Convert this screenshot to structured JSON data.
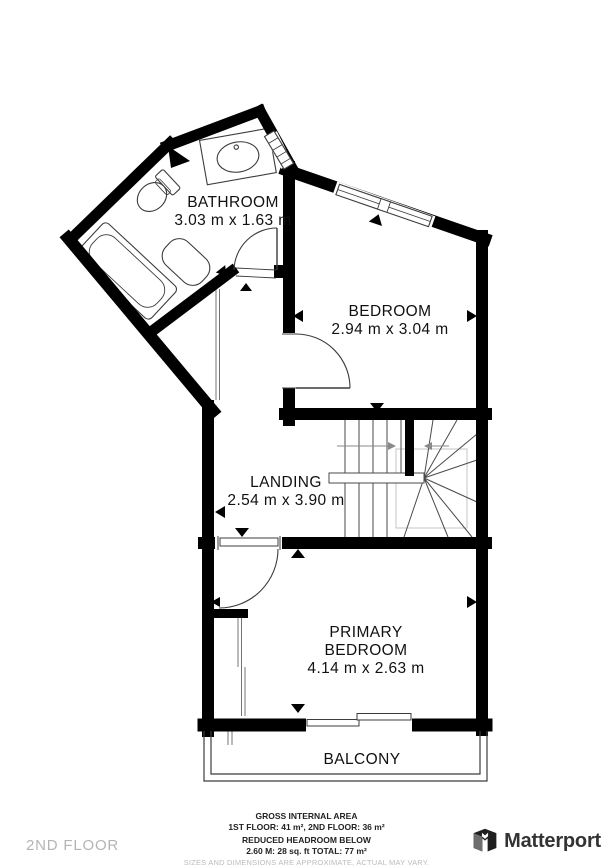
{
  "floor_plan": {
    "rooms": {
      "bathroom": {
        "name": "BATHROOM",
        "dims": "3.03 m x 1.63 m"
      },
      "bedroom": {
        "name": "BEDROOM",
        "dims": "2.94 m x 3.04 m"
      },
      "landing": {
        "name": "LANDING",
        "dims": "2.54 m x 3.90 m"
      },
      "primary_bedroom": {
        "name_line1": "PRIMARY",
        "name_line2": "BEDROOM",
        "dims": "4.14 m x 2.63 m"
      },
      "balcony": {
        "name": "BALCONY"
      }
    }
  },
  "footer": {
    "gross_area_title": "GROSS INTERNAL AREA",
    "gross_area_values": "1ST FLOOR: 41 m², 2ND FLOOR: 36 m²",
    "reduced_headroom_title": "REDUCED HEADROOM BELOW",
    "reduced_headroom_values": "2.60 M: 28 sq. ft TOTAL: 77 m²",
    "disclaimer": "SIZES AND DIMENSIONS ARE APPROXIMATE, ACTUAL MAY VARY.",
    "floor_label": "2ND FLOOR",
    "brand_name": "Matterport"
  },
  "colors": {
    "wall": "#000000",
    "fixture_line": "#3c3c3c",
    "stair_line": "#4a4a4a",
    "stair_guide": "#c4c4c4",
    "arrow": "#8a8a8a",
    "muted_text": "#b4b4b4",
    "brand_text": "#333333"
  }
}
